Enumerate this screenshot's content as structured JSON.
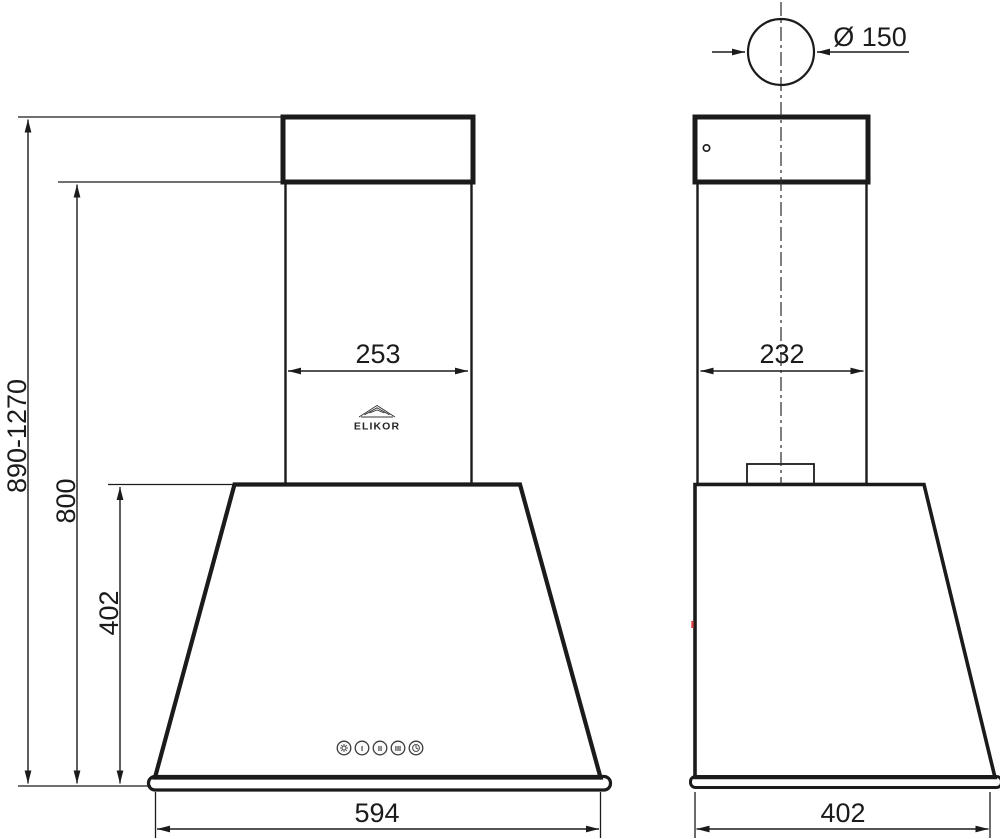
{
  "drawing": {
    "brand": "ELIKOR",
    "front_view": {
      "chimney_width_mm": "253",
      "body_width_mm": "594",
      "overall_height_range_mm": "890-1270",
      "max_height_to_body_mm": "800",
      "body_height_mm": "402",
      "controls": {
        "light_icon": "light",
        "speed1_label": "I",
        "speed2_label": "II",
        "speed3_label": "III",
        "timer_icon": "timer"
      }
    },
    "side_view": {
      "chimney_depth_mm": "232",
      "body_depth_mm": "402",
      "duct_diameter_label": "Ø 150"
    },
    "line_color": "#1b1b1b",
    "metal_light": "#fcfcfc",
    "metal_dark": "#c4c4c4"
  }
}
